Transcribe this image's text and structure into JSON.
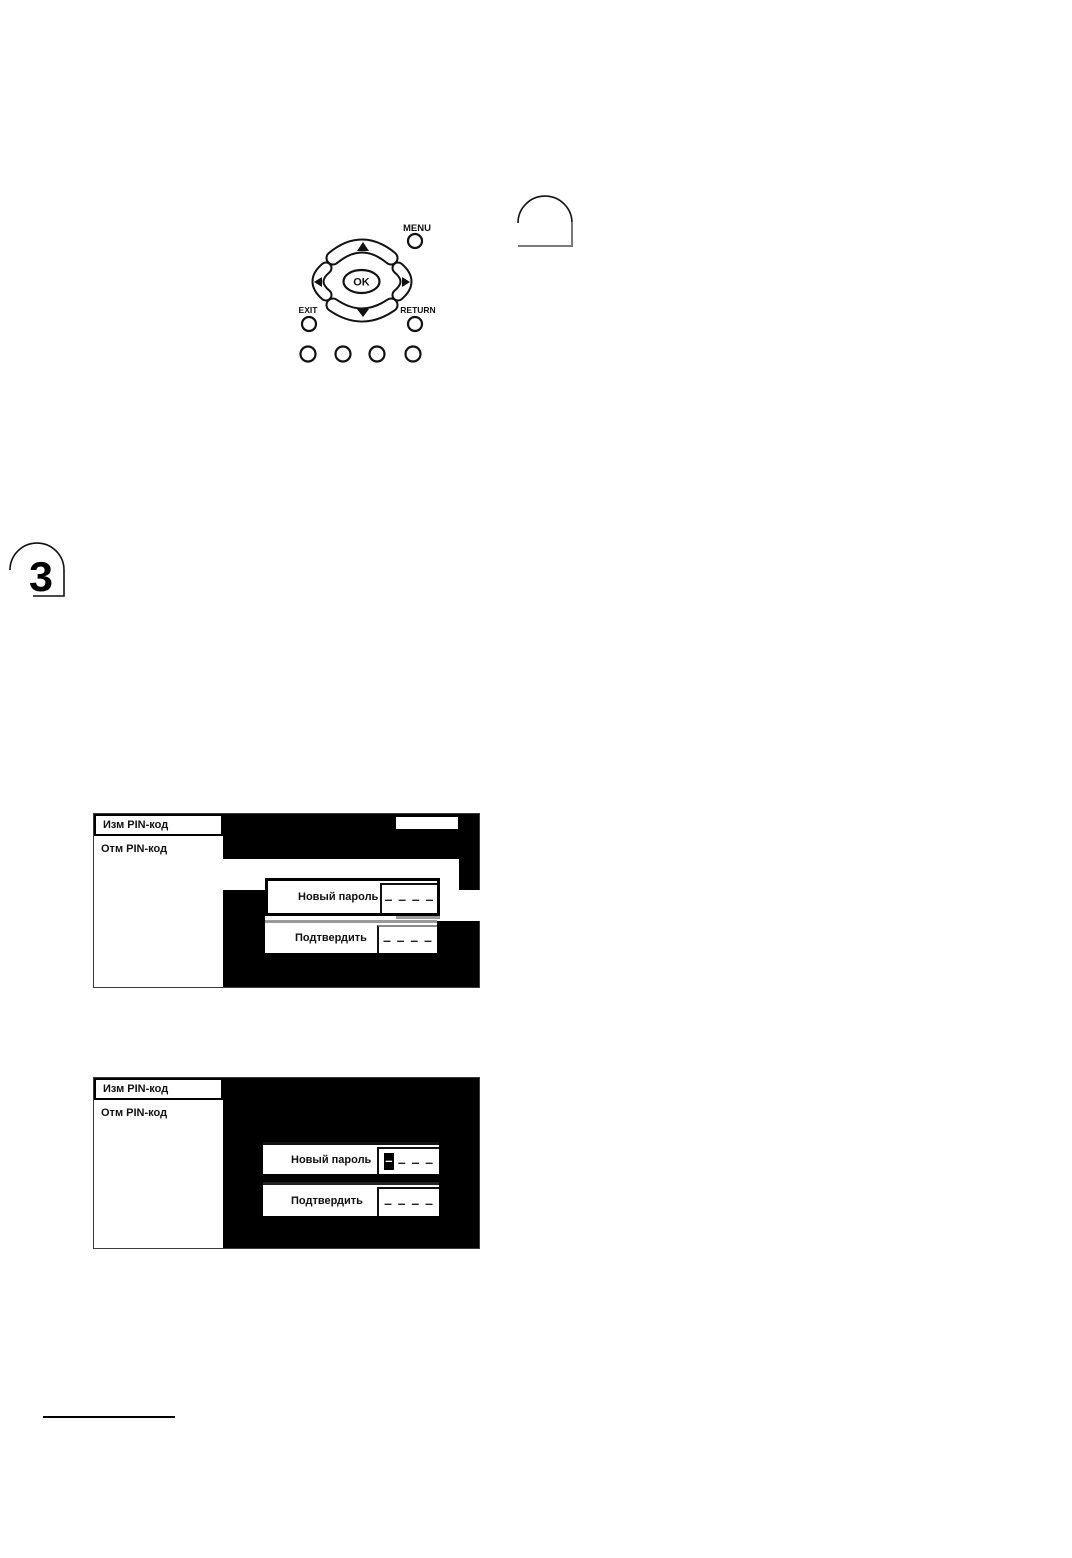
{
  "section_tab": {
    "number": "3"
  },
  "remote": {
    "menu_label": "MENU",
    "ok_label": "OK",
    "exit_label": "EXIT",
    "return_label": "RETURN"
  },
  "screen1": {
    "menu_items": [
      {
        "label": "Изм PIN-код",
        "selected": true
      },
      {
        "label": "Отм PIN-код",
        "selected": false
      }
    ],
    "fields": [
      {
        "label": "Новый пароль",
        "value": "– – – –"
      },
      {
        "label": "Подтвердить",
        "value": "– – – –"
      }
    ]
  },
  "screen2": {
    "menu_items": [
      {
        "label": "Изм PIN-код",
        "selected": true
      },
      {
        "label": "Отм PIN-код",
        "selected": false
      }
    ],
    "fields": [
      {
        "label": "Новый пароль",
        "cursor": "–",
        "value": "– – –"
      },
      {
        "label": "Подтвердить",
        "value": "– – – –"
      }
    ]
  },
  "colors": {
    "screen_background": "#000000",
    "highlight_band": "#ffffff",
    "dialog_border": "#000000"
  }
}
